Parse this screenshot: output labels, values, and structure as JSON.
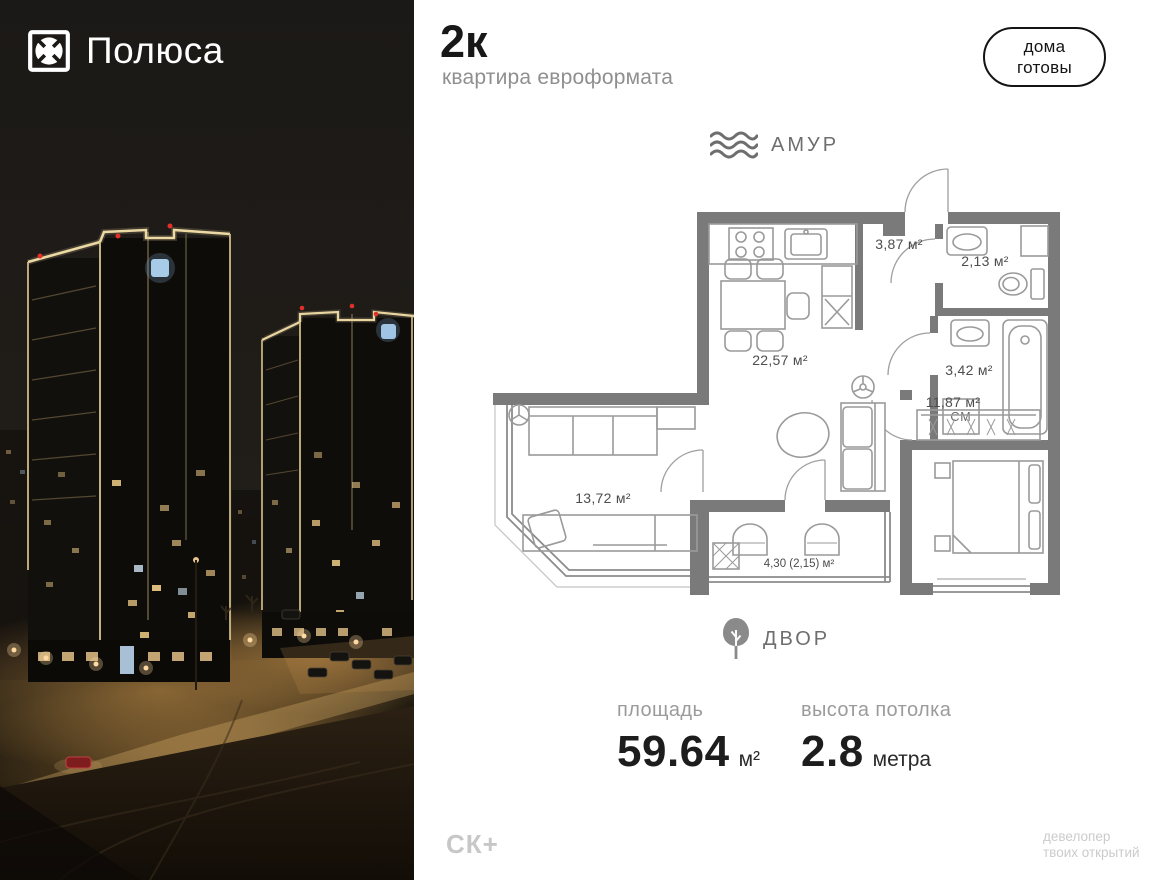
{
  "brand": {
    "name": "Полюса"
  },
  "header": {
    "type": "2к",
    "subtitle": "квартира евроформата",
    "badge_line1": "дома",
    "badge_line2": "готовы"
  },
  "orientation": {
    "river": "АМУР",
    "yard": "ДВОР"
  },
  "plan": {
    "rooms": {
      "kitchen_living": "22,57 м²",
      "hall": "3,87 м²",
      "bathroom": "2,13 м²",
      "bathroom2": "3,42 м²",
      "bedroom": "11,87 м²",
      "living": "13,72 м²",
      "balcony": "4,30 (2,15) м²"
    },
    "washer": "СМ"
  },
  "stats": {
    "area": {
      "label": "площадь",
      "value": "59.64",
      "unit": "м²"
    },
    "ceiling": {
      "label": "высота потолка",
      "value": "2.8",
      "unit": "метра"
    }
  },
  "footer": {
    "logo": "СК+",
    "tagline1": "девелопер",
    "tagline2": "твоих открытий"
  },
  "colors": {
    "badge_border": "#141414",
    "muted_text": "#8f8f8f",
    "plan_wall": "#7a7a7a",
    "night_light": "#ecd9a4",
    "logo_sign_blue": "#a8cce8"
  }
}
